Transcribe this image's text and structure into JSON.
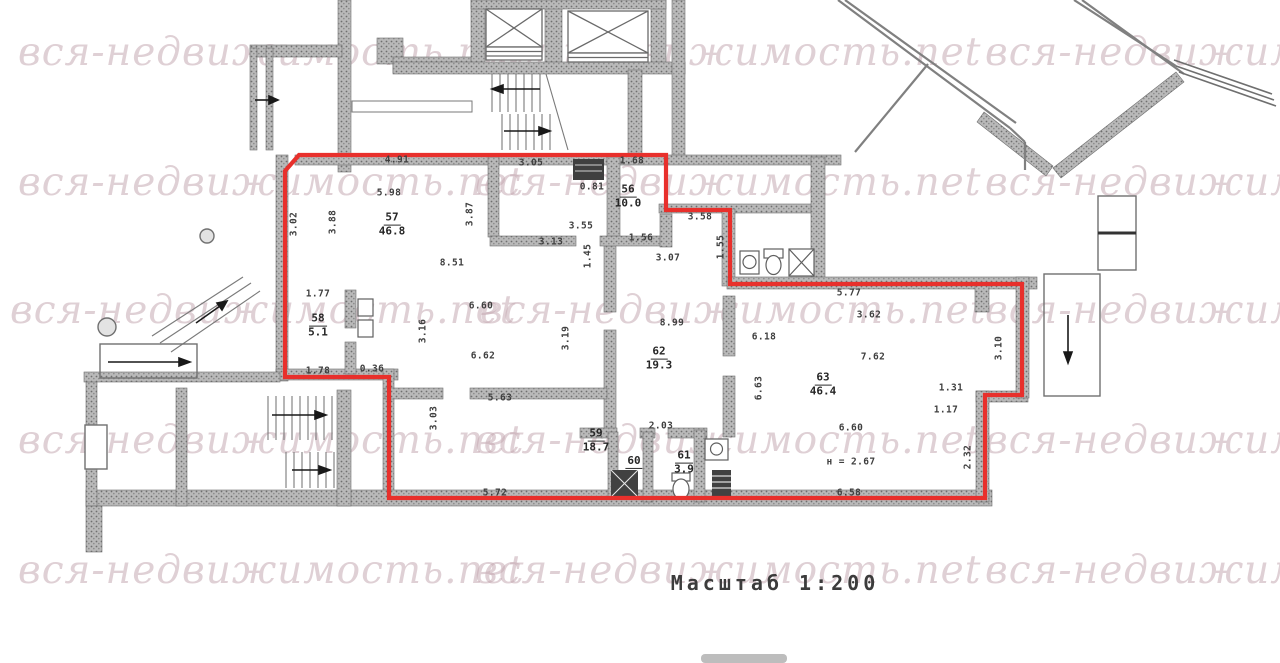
{
  "meta": {
    "scale_label": "Масштаб 1:200"
  },
  "watermark": {
    "text": "вся-недвижимость.net",
    "color": "rgba(196,170,178,0.55)",
    "instances": [
      {
        "x": 18,
        "y": 30
      },
      {
        "x": 475,
        "y": 30
      },
      {
        "x": 985,
        "y": 30
      },
      {
        "x": 18,
        "y": 160
      },
      {
        "x": 475,
        "y": 160
      },
      {
        "x": 985,
        "y": 160
      },
      {
        "x": 10,
        "y": 288
      },
      {
        "x": 480,
        "y": 288
      },
      {
        "x": 985,
        "y": 288
      },
      {
        "x": 18,
        "y": 418
      },
      {
        "x": 475,
        "y": 418
      },
      {
        "x": 985,
        "y": 418
      },
      {
        "x": 18,
        "y": 548
      },
      {
        "x": 475,
        "y": 548
      },
      {
        "x": 985,
        "y": 548
      }
    ]
  },
  "plan": {
    "red_outline_color": "#e8302c",
    "wall_color": "#b9b9b9",
    "rooms": [
      {
        "n": "56",
        "a": "10.0",
        "x": 628,
        "y": 197
      },
      {
        "n": "57",
        "a": "46.8",
        "x": 392,
        "y": 225
      },
      {
        "n": "58",
        "a": "5.1",
        "x": 318,
        "y": 326
      },
      {
        "n": "59",
        "a": "18.7",
        "x": 596,
        "y": 441
      },
      {
        "n": "60",
        "a": "",
        "x": 634,
        "y": 462
      },
      {
        "n": "61",
        "a": "3.9",
        "x": 684,
        "y": 463
      },
      {
        "n": "62",
        "a": "19.3",
        "x": 659,
        "y": 359
      },
      {
        "n": "63",
        "a": "46.4",
        "x": 823,
        "y": 385
      }
    ],
    "dimensions": [
      {
        "t": "4.91",
        "x": 397,
        "y": 160,
        "r": 0
      },
      {
        "t": "3.05",
        "x": 531,
        "y": 163,
        "r": 0
      },
      {
        "t": "1.68",
        "x": 632,
        "y": 161,
        "r": 0
      },
      {
        "t": "0.81",
        "x": 592,
        "y": 187,
        "r": 0
      },
      {
        "t": "5.98",
        "x": 389,
        "y": 193,
        "r": 0
      },
      {
        "t": "3.02",
        "x": 294,
        "y": 224,
        "r": 90
      },
      {
        "t": "3.88",
        "x": 333,
        "y": 222,
        "r": 90
      },
      {
        "t": "3.87",
        "x": 470,
        "y": 214,
        "r": 90
      },
      {
        "t": "3.55",
        "x": 581,
        "y": 226,
        "r": 0
      },
      {
        "t": "3.13",
        "x": 551,
        "y": 242,
        "r": 0
      },
      {
        "t": "1.56",
        "x": 641,
        "y": 238,
        "r": 0
      },
      {
        "t": "3.07",
        "x": 668,
        "y": 258,
        "r": 0
      },
      {
        "t": "1.45",
        "x": 588,
        "y": 256,
        "r": 90
      },
      {
        "t": "1.55",
        "x": 721,
        "y": 247,
        "r": 90
      },
      {
        "t": "3.58",
        "x": 700,
        "y": 217,
        "r": 0
      },
      {
        "t": "8.51",
        "x": 452,
        "y": 263,
        "r": 0
      },
      {
        "t": "1.77",
        "x": 318,
        "y": 294,
        "r": 0
      },
      {
        "t": "6.60",
        "x": 481,
        "y": 306,
        "r": 0
      },
      {
        "t": "3.16",
        "x": 423,
        "y": 331,
        "r": 90
      },
      {
        "t": "6.62",
        "x": 483,
        "y": 356,
        "r": 0
      },
      {
        "t": "3.19",
        "x": 566,
        "y": 338,
        "r": 90
      },
      {
        "t": "1.78",
        "x": 318,
        "y": 371,
        "r": 0
      },
      {
        "t": "0.36",
        "x": 372,
        "y": 369,
        "r": 0
      },
      {
        "t": "5.63",
        "x": 500,
        "y": 398,
        "r": 0
      },
      {
        "t": "3.03",
        "x": 434,
        "y": 418,
        "r": 90
      },
      {
        "t": "5.72",
        "x": 495,
        "y": 493,
        "r": 0
      },
      {
        "t": "2.03",
        "x": 661,
        "y": 426,
        "r": 0
      },
      {
        "t": "8.99",
        "x": 672,
        "y": 323,
        "r": 0
      },
      {
        "t": "6.18",
        "x": 764,
        "y": 337,
        "r": 0
      },
      {
        "t": "6.63",
        "x": 759,
        "y": 388,
        "r": 90
      },
      {
        "t": "5.77",
        "x": 849,
        "y": 293,
        "r": 0
      },
      {
        "t": "3.62",
        "x": 869,
        "y": 315,
        "r": 0
      },
      {
        "t": "7.62",
        "x": 873,
        "y": 357,
        "r": 0
      },
      {
        "t": "6.60",
        "x": 851,
        "y": 428,
        "r": 0
      },
      {
        "t": "н = 2.67",
        "x": 851,
        "y": 462,
        "r": 0
      },
      {
        "t": "6.58",
        "x": 849,
        "y": 493,
        "r": 0
      },
      {
        "t": "1.31",
        "x": 951,
        "y": 388,
        "r": 0
      },
      {
        "t": "1.17",
        "x": 946,
        "y": 410,
        "r": 0
      },
      {
        "t": "2.32",
        "x": 968,
        "y": 457,
        "r": 90
      },
      {
        "t": "3.10",
        "x": 999,
        "y": 348,
        "r": 90
      }
    ]
  }
}
